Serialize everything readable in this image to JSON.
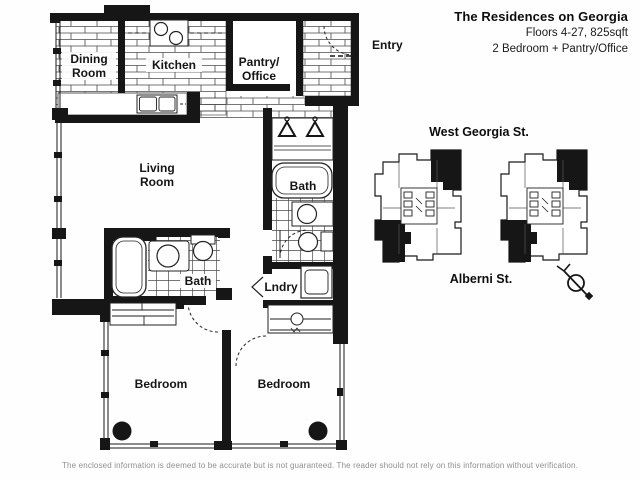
{
  "header": {
    "title": "The Residences on Georgia",
    "subtitle_floors": "Floors 4-27, 825sqft",
    "subtitle_layout": "2 Bedroom + Pantry/Office"
  },
  "floor_plan": {
    "entry": "Entry",
    "dining": {
      "line1": "Dining",
      "line2": "Room"
    },
    "kitchen": "Kitchen",
    "pantry": {
      "line1": "Pantry/",
      "line2": "Office"
    },
    "living": {
      "line1": "Living",
      "line2": "Room"
    },
    "bath_upper": "Bath",
    "bath_lower": "Bath",
    "laundry": "Lndry",
    "bedroom_left": "Bedroom",
    "bedroom_right": "Bedroom",
    "icons": {
      "stove": "stove-burners-icon",
      "sink": "double-sink-icon",
      "hangers": "clothes-hanger-icons",
      "washer": "washer-dryer-icon",
      "columns": "structural-column-dots"
    }
  },
  "site_plan": {
    "street_top": "West Georgia St.",
    "street_bottom": "Alberni St.",
    "compass": "north-arrow-icon"
  },
  "footer": {
    "disclaimer": "The enclosed information is deemed to be accurate but is not guaranteed. The reader should not rely on this information without verification."
  },
  "colors": {
    "ink": "#161616",
    "hatch_line": "#4a4a4a",
    "disclaimer_gray": "#8f8f8f",
    "paper": "#fefefe"
  }
}
